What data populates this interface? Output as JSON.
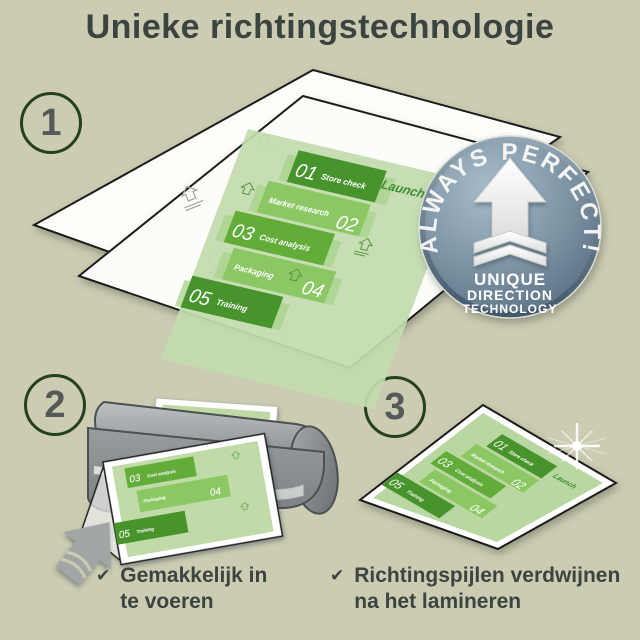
{
  "title": "Unieke richtingstechnologie",
  "colors": {
    "background": "#cbccb1",
    "text": "#3c4442",
    "panel_dark_green": "#47942c",
    "panel_medium_green": "#62ac39",
    "panel_light_green": "#8bc763",
    "document_green": "#c3dcae",
    "badge_slate": "#7d94a5"
  },
  "steps": {
    "step1": "1",
    "step2": "2",
    "step3": "3"
  },
  "badge": {
    "arc_text": "ALWAYS PERFECT!",
    "line1": "UNIQUE",
    "line2": "DIRECTION",
    "line3": "TECHNOLOGY"
  },
  "document": {
    "launch_label": "Launch",
    "panels": [
      {
        "number": "01",
        "label": "Store check"
      },
      {
        "number": "02",
        "label": "Market research"
      },
      {
        "number": "03",
        "label": "Cost analysis"
      },
      {
        "number": "04",
        "label": "Packaging"
      },
      {
        "number": "05",
        "label": "Training"
      }
    ]
  },
  "checklist": [
    {
      "line1": "Gemakkelijk in",
      "line2": "te voeren"
    },
    {
      "line1": "Richtingspijlen verdwijnen",
      "line2": "na het lamineren"
    }
  ],
  "icons": {
    "checkmark": "✔"
  }
}
